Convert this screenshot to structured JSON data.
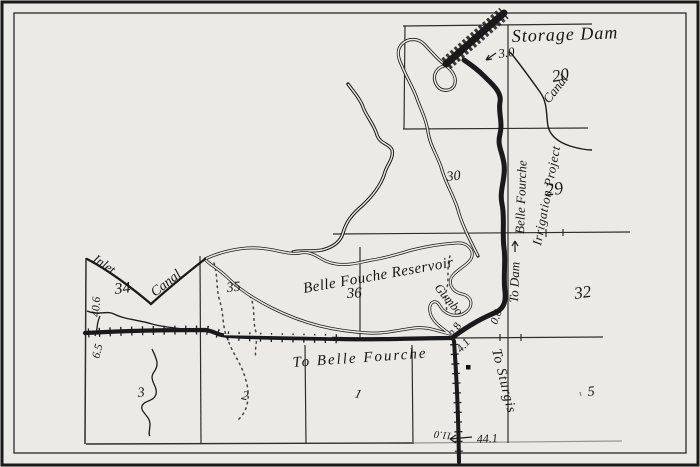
{
  "map": {
    "labels": {
      "storage_dam": "Storage Dam",
      "reservoir": "Belle Fouche Reservoir",
      "to_belle_fourche": "To Belle Fourche",
      "to_sturgis": "To Sturgis",
      "to_dam": "To Dam",
      "inlet": "Inlet",
      "canal_west": "Canal",
      "belle_fourche_canal_line1": "Belle Fourche",
      "belle_fourche_canal_line2": "Irrigation Project",
      "belle_fourche_canal_line3": "Canal",
      "gumbo": "Gumbo"
    },
    "sections": {
      "s20": "20",
      "s29": "29",
      "s30": "30",
      "s32": "32",
      "s34": "34",
      "s35": "35",
      "s36": "36",
      "s3": "3",
      "s2": "2",
      "s1": "1",
      "s5": "5"
    },
    "distances": {
      "d3_0": "3.0",
      "d0_6": "0.6",
      "d2_8": "2.8",
      "d4_1": "4.1",
      "d40_6": "40.6",
      "d6_5": "6.5",
      "d44_1": "44.1",
      "d11_0": "11.0"
    },
    "colors": {
      "ink": "#1a1a1a",
      "paper": "#eceae6"
    }
  }
}
